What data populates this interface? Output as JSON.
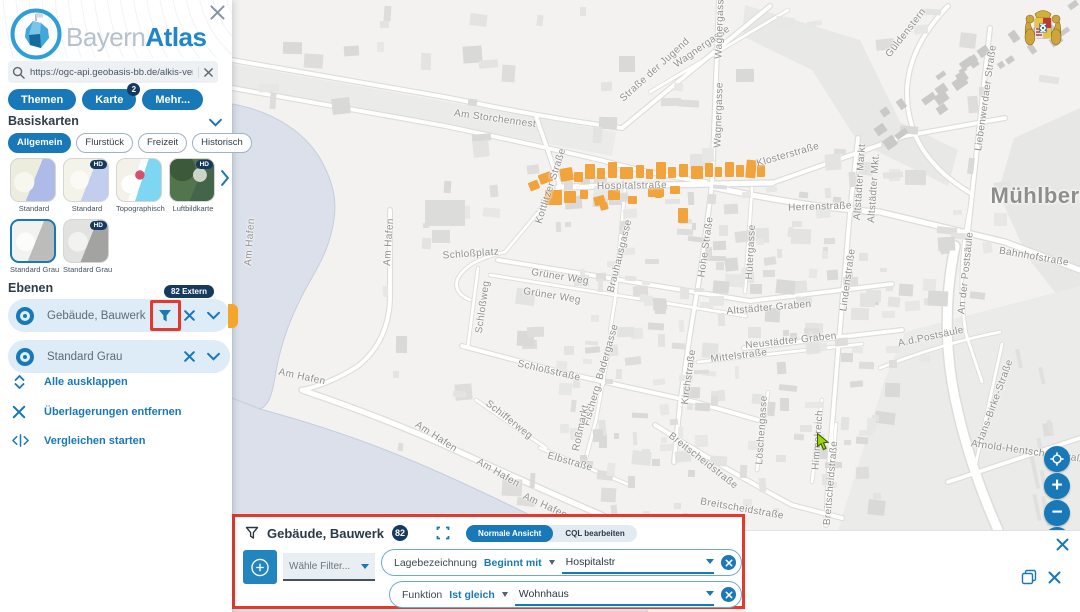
{
  "app": {
    "title_light": "Bayern",
    "title_bold": "Atlas"
  },
  "sidebar": {
    "search": {
      "value": "https://ogc-api.geobasis-bb.de/alkis-verein"
    },
    "tabs": [
      {
        "label": "Themen"
      },
      {
        "label": "Karte",
        "badge": "2"
      },
      {
        "label": "Mehr..."
      }
    ],
    "basiskarten": {
      "title": "Basiskarten",
      "chips": [
        {
          "label": "Allgemein",
          "active": true
        },
        {
          "label": "Flurstück",
          "active": false
        },
        {
          "label": "Freizeit",
          "active": false
        },
        {
          "label": "Historisch",
          "active": false
        }
      ],
      "thumbs": [
        {
          "label": "Standard",
          "style": "t-std1",
          "hd": false,
          "selected": false
        },
        {
          "label": "Standard",
          "style": "t-std2",
          "hd": true,
          "selected": false
        },
        {
          "label": "Topographisch",
          "style": "t-topo",
          "hd": false,
          "selected": false
        },
        {
          "label": "Luftbildkarte",
          "style": "t-aerial",
          "hd": true,
          "selected": false
        },
        {
          "label": "Standard Grau",
          "style": "t-gray1",
          "hd": false,
          "selected": true
        },
        {
          "label": "Standard Grau",
          "style": "t-gray2",
          "hd": true,
          "selected": false
        }
      ]
    },
    "ebenen": {
      "title": "Ebenen",
      "layers": [
        {
          "name": "Gebäude, Bauwerk",
          "badge": "82 Extern",
          "has_filter": true,
          "annotated": true,
          "orange_tab": true
        },
        {
          "name": "Standard Grau",
          "badge": "",
          "has_filter": false,
          "annotated": false,
          "orange_tab": false
        }
      ]
    },
    "actions": [
      {
        "icon": "expand-all-icon",
        "label": "Alle ausklappen"
      },
      {
        "icon": "remove-overlays-icon",
        "label": "Überlagerungen entfernen"
      },
      {
        "icon": "compare-icon",
        "label": "Vergleichen starten"
      }
    ]
  },
  "filter_panel": {
    "title": "Gebäude, Bauwerk",
    "count": "82",
    "views": [
      {
        "label": "Normale Ansicht",
        "active": true
      },
      {
        "label": "CQL bearbeiten",
        "active": false
      }
    ],
    "choose_filter_placeholder": "Wähle Filter...",
    "rows": [
      {
        "field": "Lagebezeichnung",
        "operator": "Beginnt mit",
        "value": "Hospitalstr"
      },
      {
        "field": "Funktion",
        "operator": "Ist gleich",
        "value": "Wohnhaus"
      }
    ]
  },
  "map": {
    "big_label": {
      "text": "Mühlberg",
      "x": 1042,
      "y": 196
    },
    "labels": [
      {
        "t": "Am Storchennest",
        "x": 495,
        "y": 119,
        "r": 8
      },
      {
        "t": "Straße der Jugend",
        "x": 655,
        "y": 70,
        "r": -42
      },
      {
        "t": "Wagnergasse",
        "x": 702,
        "y": 47,
        "r": -35
      },
      {
        "t": "Wagnergasse",
        "x": 720,
        "y": 26,
        "r": -88
      },
      {
        "t": "Wagnergasse",
        "x": 719,
        "y": 115,
        "r": -88
      },
      {
        "t": "Güldenstern",
        "x": 906,
        "y": 33,
        "r": -52
      },
      {
        "t": "Liebenwerdaer Straße",
        "x": 986,
        "y": 98,
        "r": -82
      },
      {
        "t": "Klosterstraße",
        "x": 788,
        "y": 155,
        "r": -16
      },
      {
        "t": "Kottlitzer Straße",
        "x": 551,
        "y": 186,
        "r": -72
      },
      {
        "t": "Hospitalstraße",
        "x": 632,
        "y": 186,
        "r": -1
      },
      {
        "t": "Herrenstraße",
        "x": 820,
        "y": 207,
        "r": -2
      },
      {
        "t": "Altstädter Markt",
        "x": 860,
        "y": 182,
        "r": -86
      },
      {
        "t": "Altstädter Mkt.",
        "x": 874,
        "y": 188,
        "r": -86
      },
      {
        "t": "Bahnhofstraße",
        "x": 1034,
        "y": 257,
        "r": 10
      },
      {
        "t": "An der Postsäule",
        "x": 966,
        "y": 273,
        "r": -84
      },
      {
        "t": "A.d.Postsäule",
        "x": 931,
        "y": 337,
        "r": -12
      },
      {
        "t": "Lindenstraße",
        "x": 848,
        "y": 280,
        "r": -82
      },
      {
        "t": "Hohe Straße",
        "x": 706,
        "y": 247,
        "r": -82
      },
      {
        "t": "Hütergasse",
        "x": 751,
        "y": 252,
        "r": -87
      },
      {
        "t": "Brauhausgasse",
        "x": 620,
        "y": 256,
        "r": -76
      },
      {
        "t": "Grüner Weg",
        "x": 560,
        "y": 277,
        "r": 9
      },
      {
        "t": "Grüner Weg",
        "x": 552,
        "y": 296,
        "r": 9
      },
      {
        "t": "Schloßplatz",
        "x": 471,
        "y": 254,
        "r": -4
      },
      {
        "t": "Schloßweg",
        "x": 483,
        "y": 307,
        "r": -82
      },
      {
        "t": "Altstädter Graben",
        "x": 769,
        "y": 308,
        "r": -5
      },
      {
        "t": "Neustädter Graben",
        "x": 791,
        "y": 341,
        "r": -6
      },
      {
        "t": "Mittelstraße",
        "x": 739,
        "y": 356,
        "r": -7
      },
      {
        "t": "Kirchstraße",
        "x": 689,
        "y": 377,
        "r": -82
      },
      {
        "t": "Schloßstraße",
        "x": 549,
        "y": 371,
        "r": 13
      },
      {
        "t": "Fischerg. Badergasse",
        "x": 601,
        "y": 375,
        "r": -74
      },
      {
        "t": "Roßmarkt",
        "x": 581,
        "y": 428,
        "r": -78
      },
      {
        "t": "Schifferweg",
        "x": 509,
        "y": 420,
        "r": 38
      },
      {
        "t": "Elbstraße",
        "x": 570,
        "y": 462,
        "r": 16
      },
      {
        "t": "Am Hafen",
        "x": 250,
        "y": 242,
        "r": -86
      },
      {
        "t": "Am Hafen",
        "x": 389,
        "y": 242,
        "r": -86
      },
      {
        "t": "Am Hafen",
        "x": 302,
        "y": 377,
        "r": 12
      },
      {
        "t": "Am Hafen",
        "x": 436,
        "y": 437,
        "r": 33
      },
      {
        "t": "Am Hafen",
        "x": 498,
        "y": 473,
        "r": 30
      },
      {
        "t": "Am Hafen",
        "x": 545,
        "y": 506,
        "r": 25
      },
      {
        "t": "Löschengasse",
        "x": 762,
        "y": 430,
        "r": -86
      },
      {
        "t": "Himmelreich",
        "x": 818,
        "y": 440,
        "r": -86
      },
      {
        "t": "Breitscheidstraße",
        "x": 703,
        "y": 461,
        "r": 38
      },
      {
        "t": "Breitscheidstraße",
        "x": 742,
        "y": 509,
        "r": 10
      },
      {
        "t": "Breitscheidstraße",
        "x": 831,
        "y": 483,
        "r": -85
      },
      {
        "t": "Hans-Birke-Straße",
        "x": 995,
        "y": 402,
        "r": -70
      },
      {
        "t": "Arnold-Hentschel-Straße",
        "x": 1030,
        "y": 452,
        "r": 8
      }
    ],
    "buildings_color": "#f2a33c",
    "buildings": [
      [
        585,
        164,
        10,
        15,
        0
      ],
      [
        597,
        168,
        8,
        11,
        0
      ],
      [
        608,
        162,
        9,
        16,
        0
      ],
      [
        620,
        167,
        13,
        12,
        0
      ],
      [
        636,
        165,
        8,
        13,
        0
      ],
      [
        646,
        169,
        7,
        10,
        0
      ],
      [
        656,
        162,
        10,
        17,
        0
      ],
      [
        668,
        167,
        8,
        11,
        0
      ],
      [
        679,
        164,
        9,
        13,
        0
      ],
      [
        691,
        166,
        12,
        13,
        0
      ],
      [
        705,
        163,
        8,
        14,
        0
      ],
      [
        715,
        167,
        7,
        10,
        0
      ],
      [
        725,
        162,
        9,
        15,
        0
      ],
      [
        736,
        165,
        8,
        12,
        0
      ],
      [
        746,
        160,
        10,
        18,
        5
      ],
      [
        757,
        165,
        8,
        12,
        0
      ],
      [
        560,
        168,
        13,
        13,
        -10
      ],
      [
        574,
        172,
        9,
        10,
        0
      ],
      [
        539,
        173,
        13,
        10,
        -20
      ],
      [
        529,
        181,
        10,
        9,
        -22
      ],
      [
        545,
        190,
        17,
        15,
        0
      ],
      [
        564,
        191,
        12,
        12,
        0
      ],
      [
        580,
        190,
        8,
        9,
        0
      ],
      [
        594,
        196,
        11,
        9,
        -15
      ],
      [
        608,
        190,
        12,
        10,
        0
      ],
      [
        600,
        203,
        8,
        7,
        -15
      ],
      [
        648,
        188,
        16,
        9,
        0
      ],
      [
        670,
        186,
        10,
        8,
        0
      ],
      [
        678,
        208,
        10,
        15,
        0
      ],
      [
        628,
        196,
        9,
        8,
        0
      ],
      [
        655,
        191,
        7,
        7,
        0
      ]
    ]
  }
}
